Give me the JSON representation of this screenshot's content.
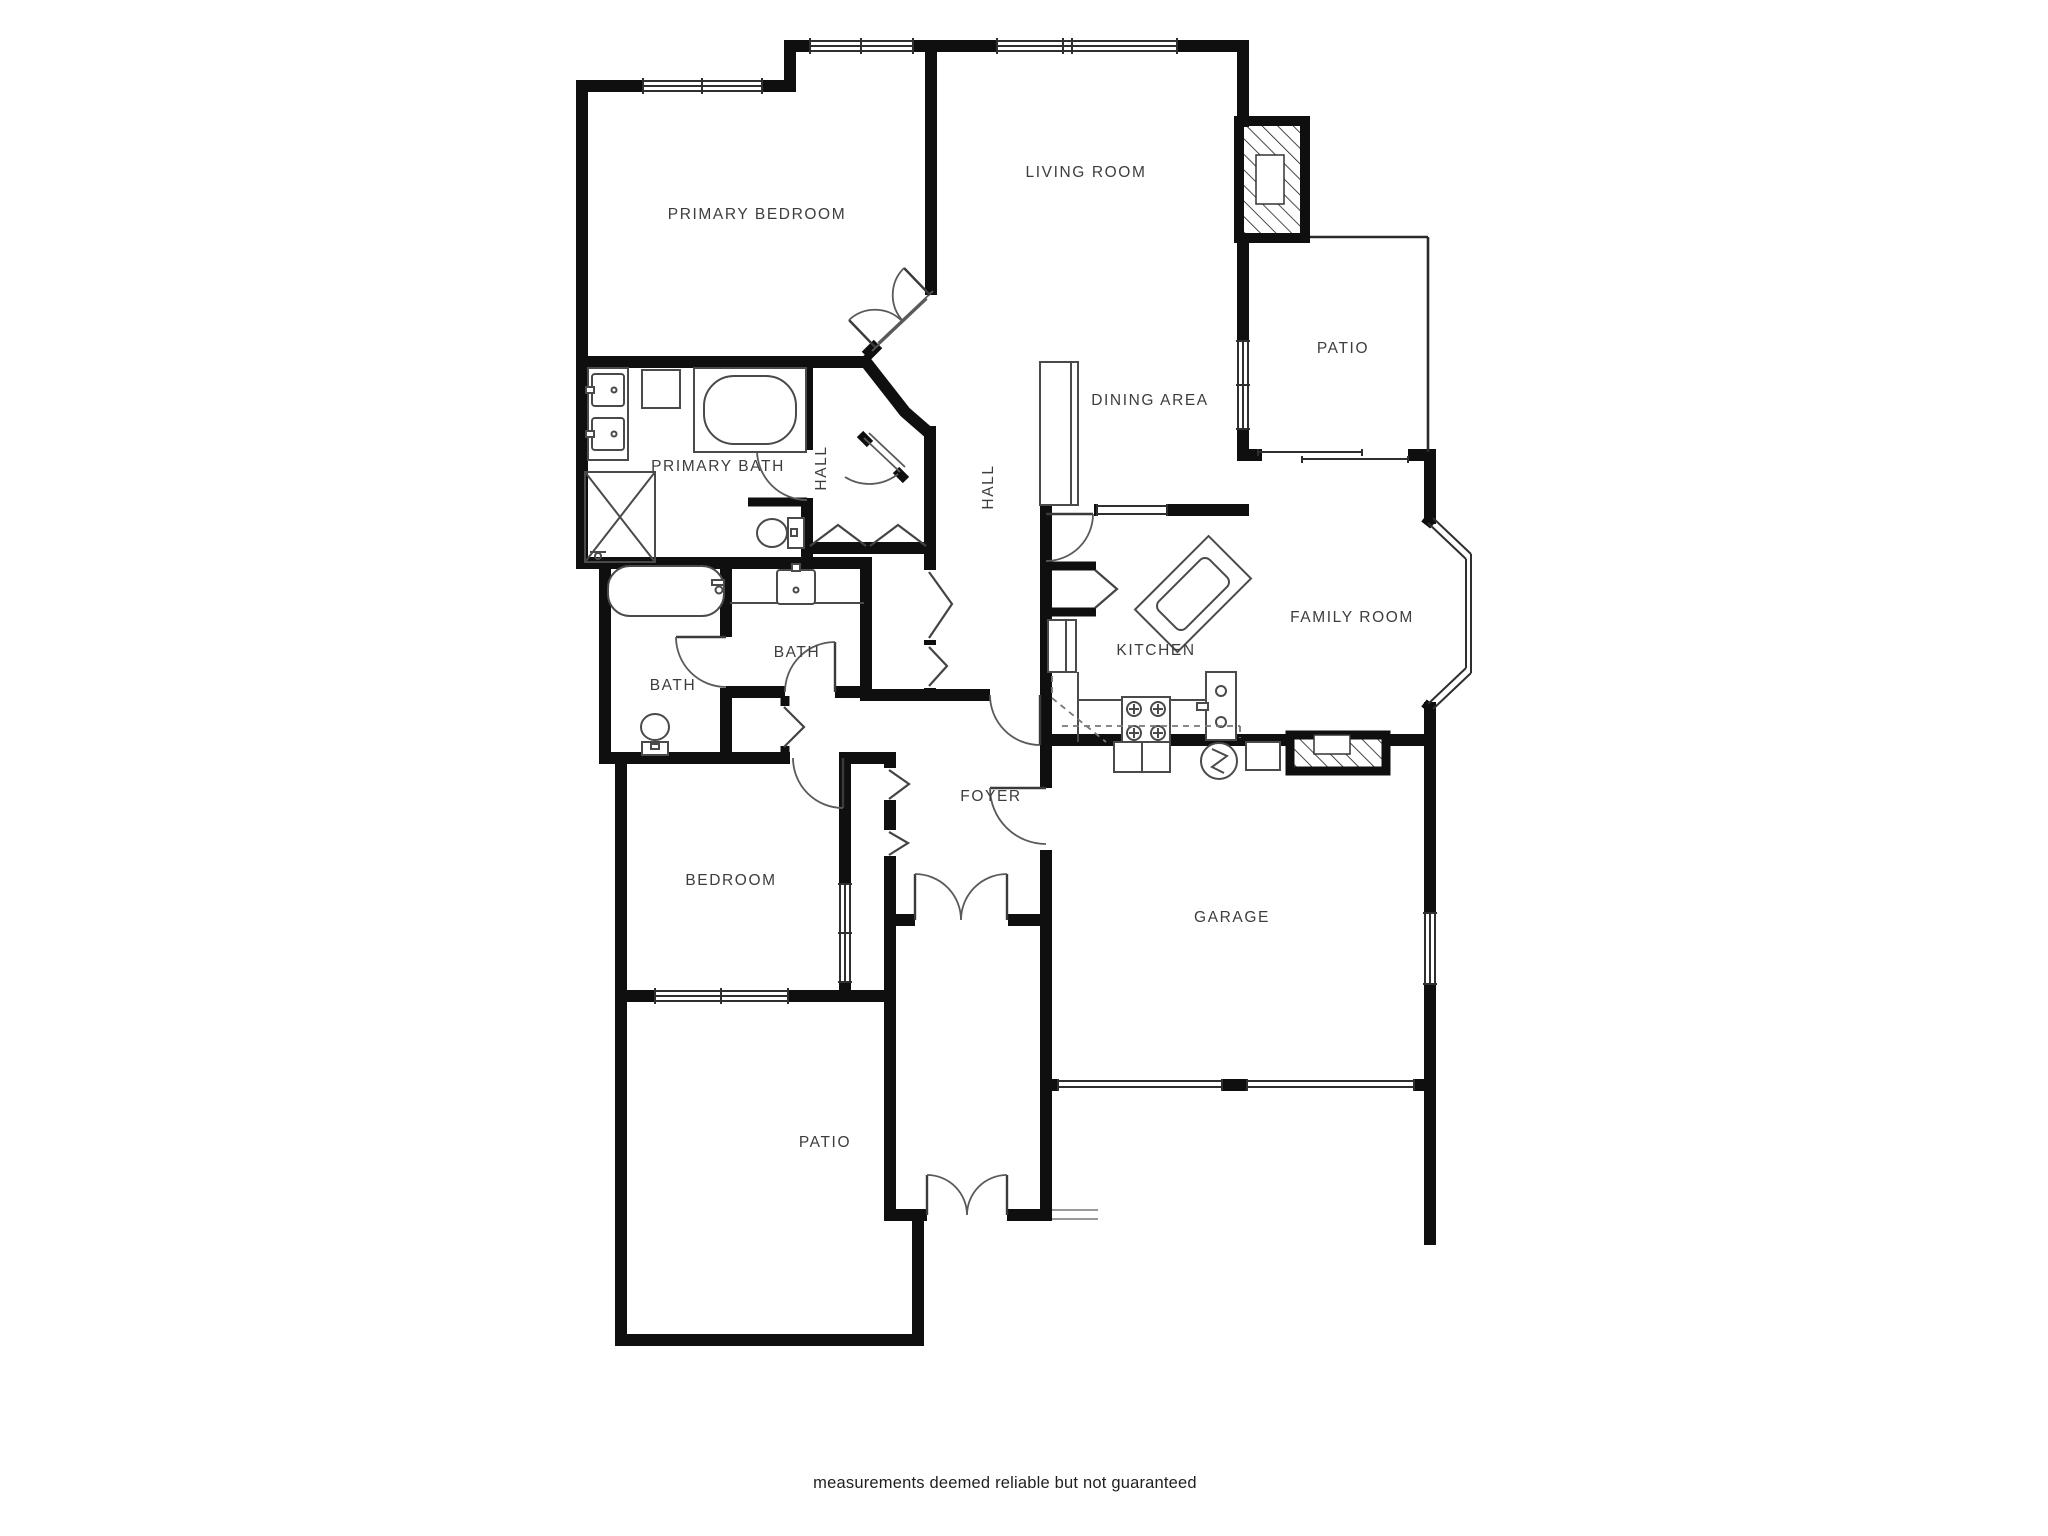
{
  "plan": {
    "type": "single-family-floor-plan",
    "wall_color": "#0f0f0f",
    "background": "#ffffff",
    "label_color": "#3d3d3d"
  },
  "labels": [
    {
      "id": "primary-bedroom",
      "text": "PRIMARY BEDROOM"
    },
    {
      "id": "living-room",
      "text": "LIVING ROOM"
    },
    {
      "id": "patio-upper",
      "text": "PATIO"
    },
    {
      "id": "dining-area",
      "text": "DINING AREA"
    },
    {
      "id": "primary-bath",
      "text": "PRIMARY BATH"
    },
    {
      "id": "hall-west",
      "text": "HALL"
    },
    {
      "id": "hall-east",
      "text": "HALL"
    },
    {
      "id": "family-room",
      "text": "FAMILY ROOM"
    },
    {
      "id": "kitchen",
      "text": "KITCHEN"
    },
    {
      "id": "bath-left",
      "text": "BATH"
    },
    {
      "id": "bath-right",
      "text": "BATH"
    },
    {
      "id": "foyer",
      "text": "FOYER"
    },
    {
      "id": "bedroom",
      "text": "BEDROOM"
    },
    {
      "id": "garage",
      "text": "GARAGE"
    },
    {
      "id": "patio-lower",
      "text": "PATIO"
    }
  ],
  "caption": {
    "text": "measurements deemed reliable but not guaranteed"
  }
}
